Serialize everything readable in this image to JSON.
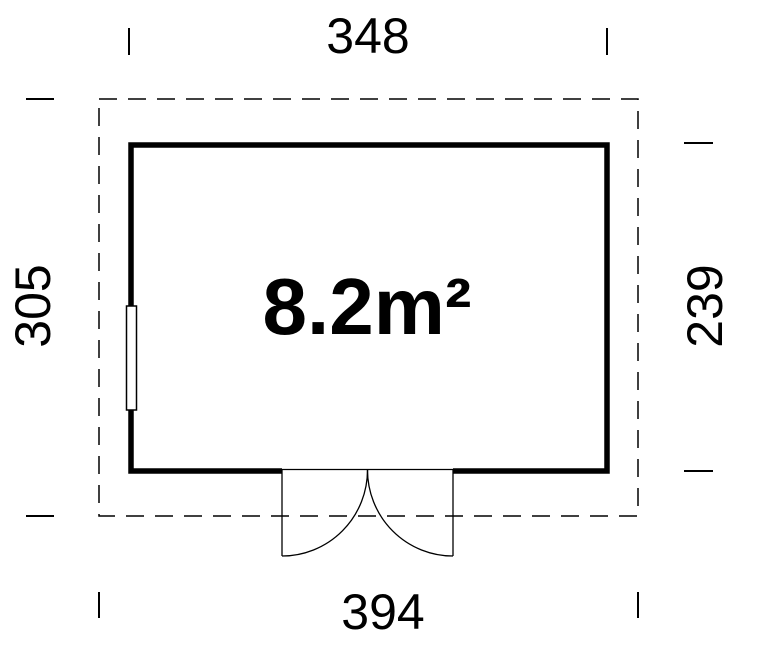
{
  "colors": {
    "line": "#000000",
    "background": "#ffffff"
  },
  "plan": {
    "area_label": "8.2m²",
    "dimensions": {
      "top": "348",
      "bottom": "394",
      "left": "305",
      "right": "239"
    }
  }
}
